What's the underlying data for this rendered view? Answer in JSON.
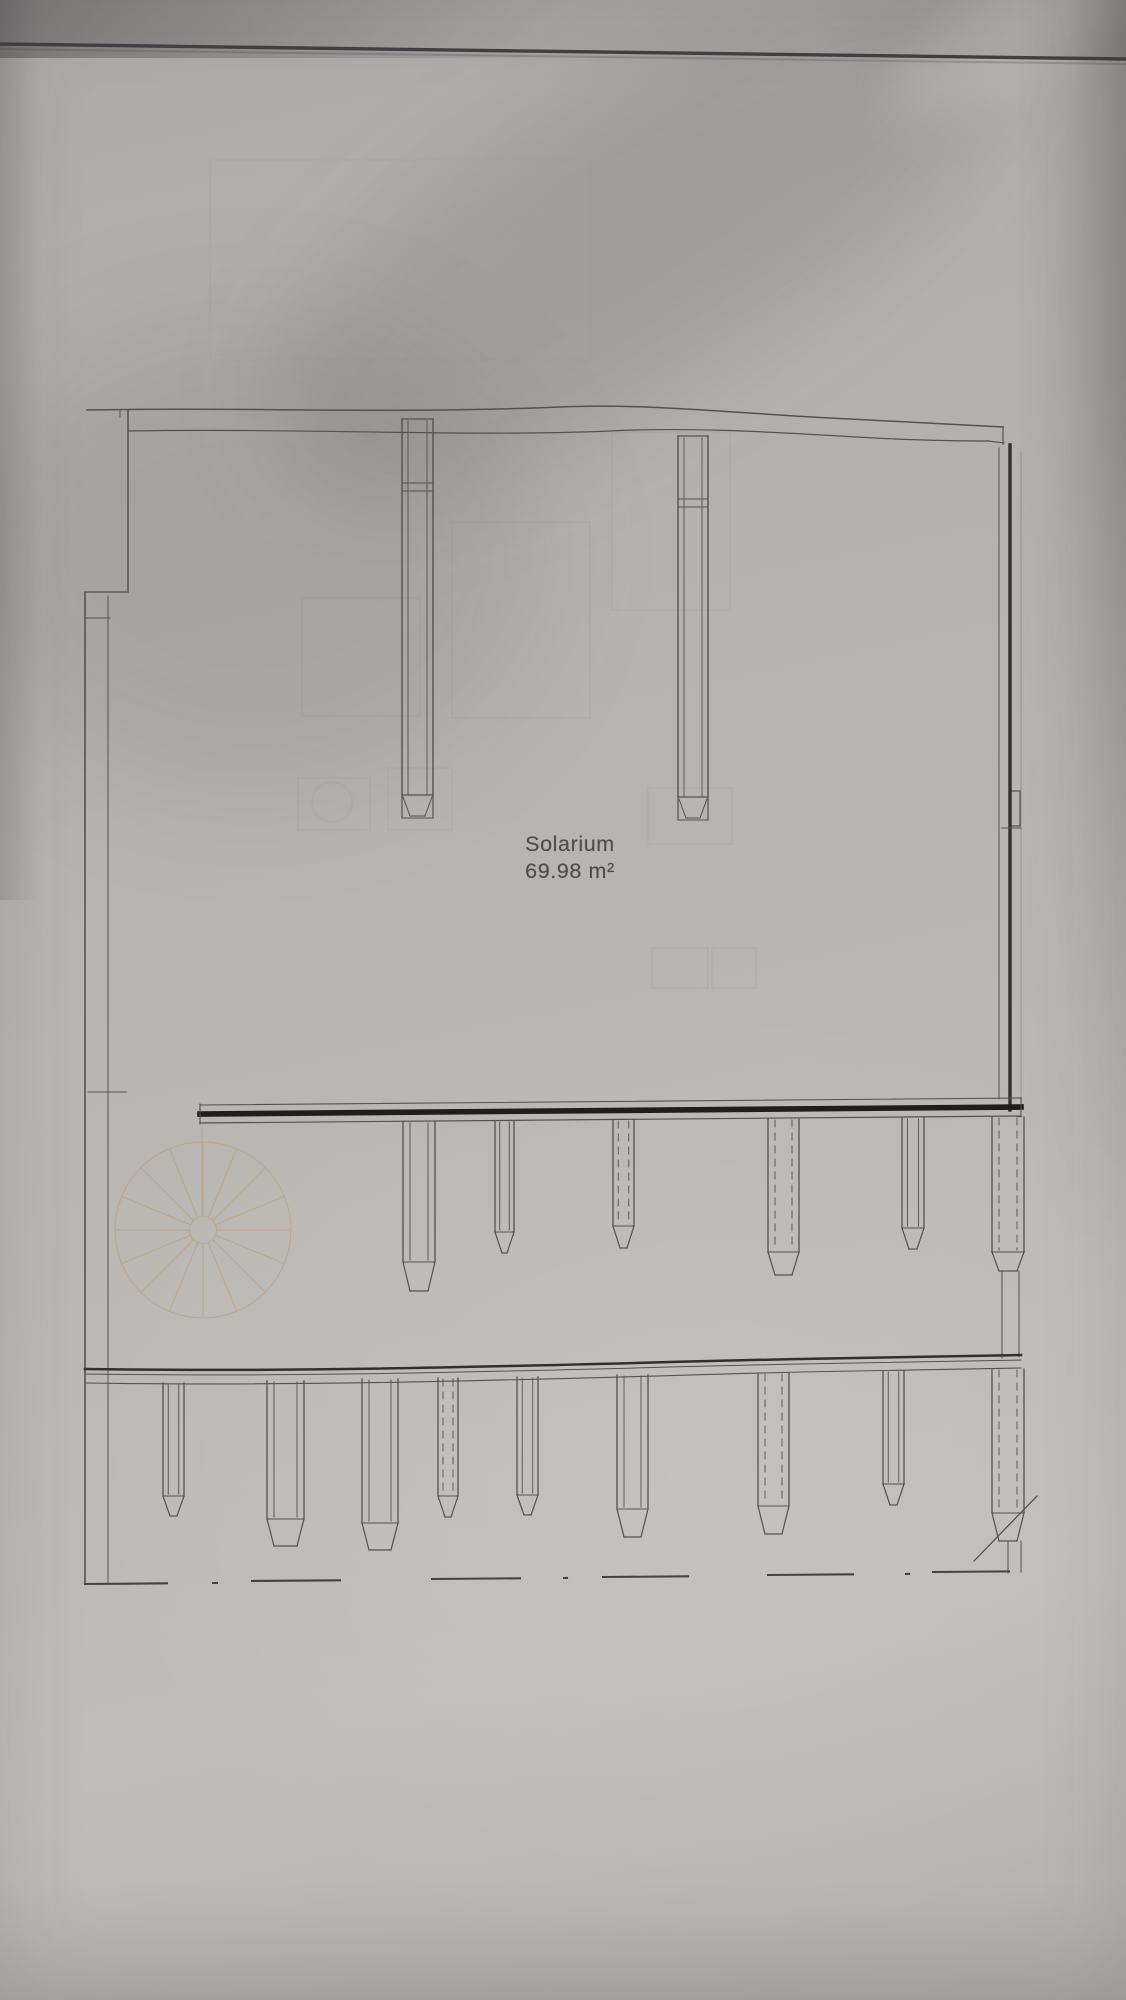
{
  "plan": {
    "room_name": "Solarium",
    "room_area": "69.98 m²"
  },
  "colors": {
    "paper": "#b5b2ad",
    "ink": "#55524c",
    "ink_dark": "#23221f",
    "edge_band_dark": "#1f1e1b",
    "stair_line": "#b99e7c"
  }
}
